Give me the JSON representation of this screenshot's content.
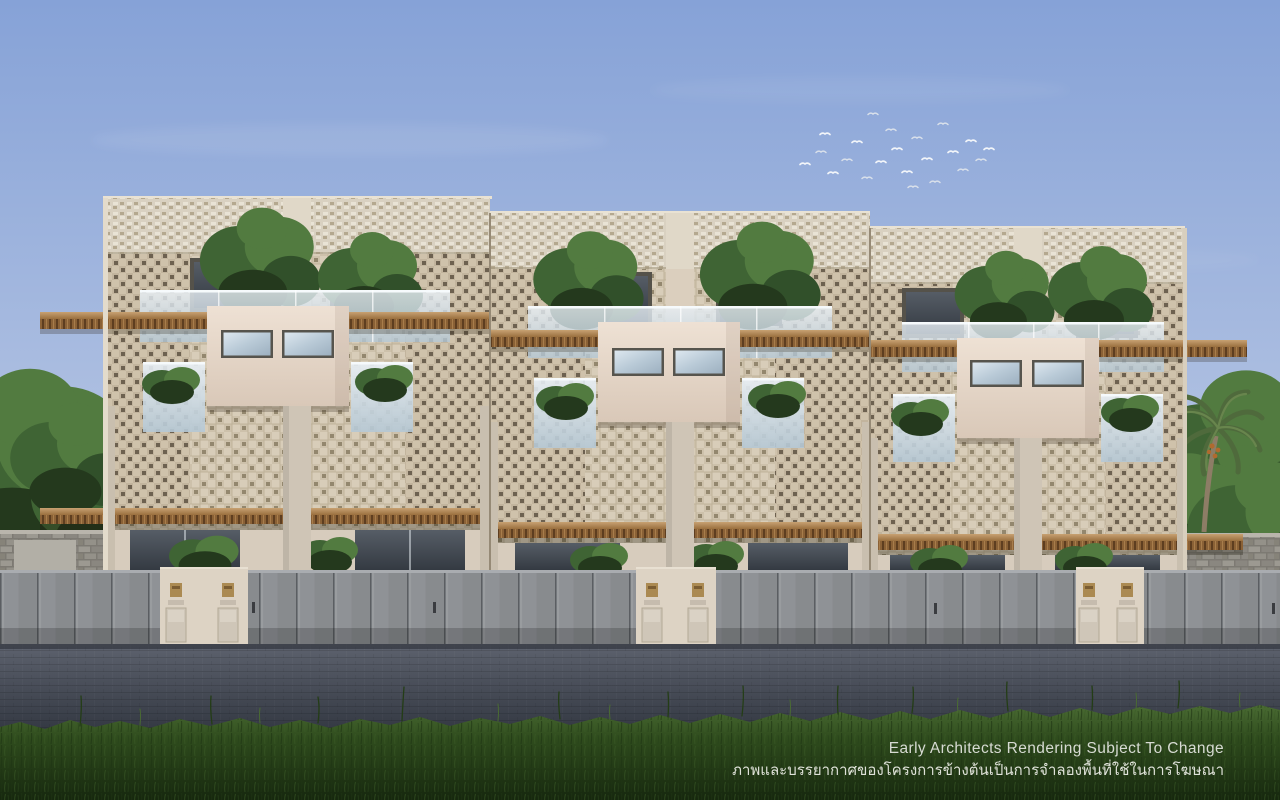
{
  "scene": {
    "subject": "Architectural rendering of three-storey breeze-block townhomes behind a grey fence with lawn in the foreground",
    "sky": "clear blue sky with a flock of birds",
    "foreground": "asphalt road and dark green grass lawn"
  },
  "disclaimer": {
    "line1": "Early Architects Rendering Subject To Change",
    "line2": "ภาพและบรรยากาศของโครงการข้างต้นเป็นการจำลองพื้นที่ใช้ในการโฆษณา"
  },
  "colors": {
    "sky_top": "#86a2d7",
    "sky_horizon": "#ccd7ec",
    "facade_beige": "#cdc1ab",
    "parapet_light": "#d9d1c1",
    "breeze_dark": "#c2b49d",
    "wood_light": "#c7a172",
    "wood_dark": "#9a6f3e",
    "cream_light": "#eee1d4",
    "cream_dark": "#d9c8b8",
    "glass_light": "#e9f0f6",
    "glass_dark": "#b5c8d5",
    "fence_grey": "#8f9296",
    "pillar_cream": "#ddd3c4",
    "road_grey": "#4a4f5a",
    "grass_green": "#2f4c1d",
    "tree_green": "#3f6434",
    "text": "#d7dbd3"
  }
}
